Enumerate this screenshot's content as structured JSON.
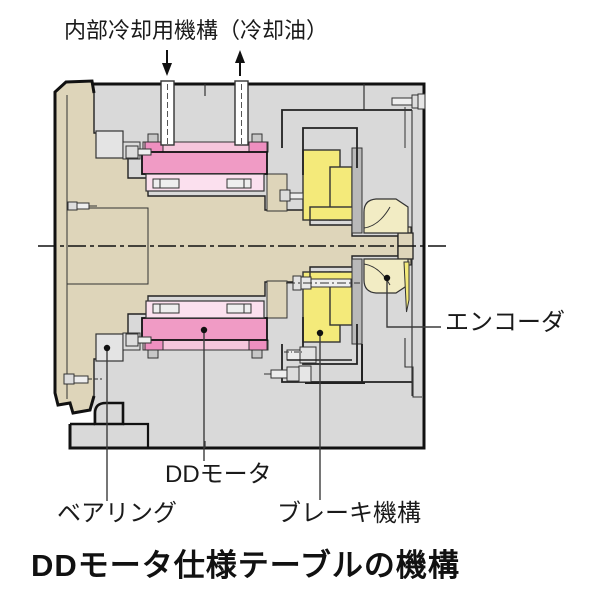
{
  "figure": {
    "top_label": "内部冷却用機構（冷却油）",
    "labels": {
      "encoder": "エンコーダ",
      "dd_motor": "DDモータ",
      "bearing": "ベアリング",
      "brake": "ブレーキ機構"
    },
    "title": "DDモータ仕様テーブルの機構"
  },
  "colors": {
    "housing_gray": "#d9d9d9",
    "shaft_beige": "#ded5ba",
    "stator_pink": "#f09bc5",
    "rotor_pink": "#fbe0ee",
    "clamp_pink": "#f6c6dc",
    "clamp_block_pink": "#ee8fc0",
    "brake_yellow": "#f4ea7a",
    "encoder_cream": "#f2ecc4",
    "bearing_gray": "#e4e4e4",
    "side_plate_gray": "#b9b9b9",
    "outline": "#111111",
    "leader": "#3c3c3c"
  }
}
